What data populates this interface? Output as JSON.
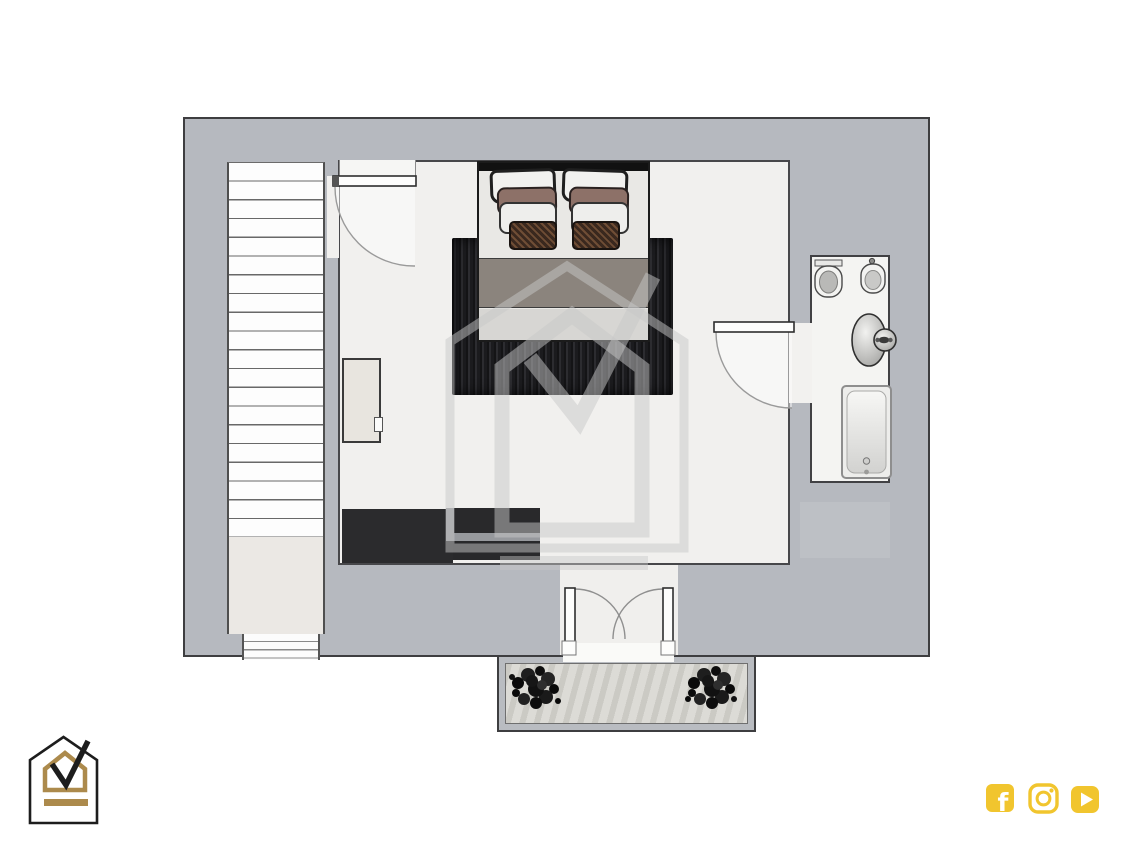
{
  "page": {
    "background": "#ffffff",
    "content_type": "residential-floor-plan-render"
  },
  "plan": {
    "wall_color": "#b6b9bf",
    "floor_color": "#f1f0ee",
    "outline_color": "#3e3e40",
    "rooms": [
      {
        "label": "staircase"
      },
      {
        "label": "bedroom"
      },
      {
        "label": "bathroom"
      },
      {
        "label": "balcony"
      }
    ],
    "furniture": [
      {
        "label": "double-bed-with-pillows"
      },
      {
        "label": "dark-area-rug"
      },
      {
        "label": "wardrobe-unit"
      },
      {
        "label": "dresser"
      }
    ],
    "fixtures": [
      {
        "label": "toilet"
      },
      {
        "label": "bidet"
      },
      {
        "label": "washbasin"
      },
      {
        "label": "bathtub"
      }
    ],
    "doors": [
      {
        "label": "bedroom-entry-door"
      },
      {
        "label": "bathroom-door"
      },
      {
        "label": "balcony-double-door"
      }
    ],
    "decor": [
      {
        "label": "potted-plant-left"
      },
      {
        "label": "potted-plant-right"
      }
    ]
  },
  "branding": {
    "logo": {
      "label": "house-checkmark-logo",
      "outline_color": "#1d1d1d",
      "accent_color": "#ac8a4c"
    },
    "watermark": {
      "label": "house-checkmark-watermark",
      "color": "#c8c8c8"
    }
  },
  "social": {
    "accent_color": "#f1c52e",
    "facebook_glyph": "f",
    "icons": [
      {
        "label": "facebook"
      },
      {
        "label": "instagram"
      },
      {
        "label": "youtube"
      }
    ]
  }
}
